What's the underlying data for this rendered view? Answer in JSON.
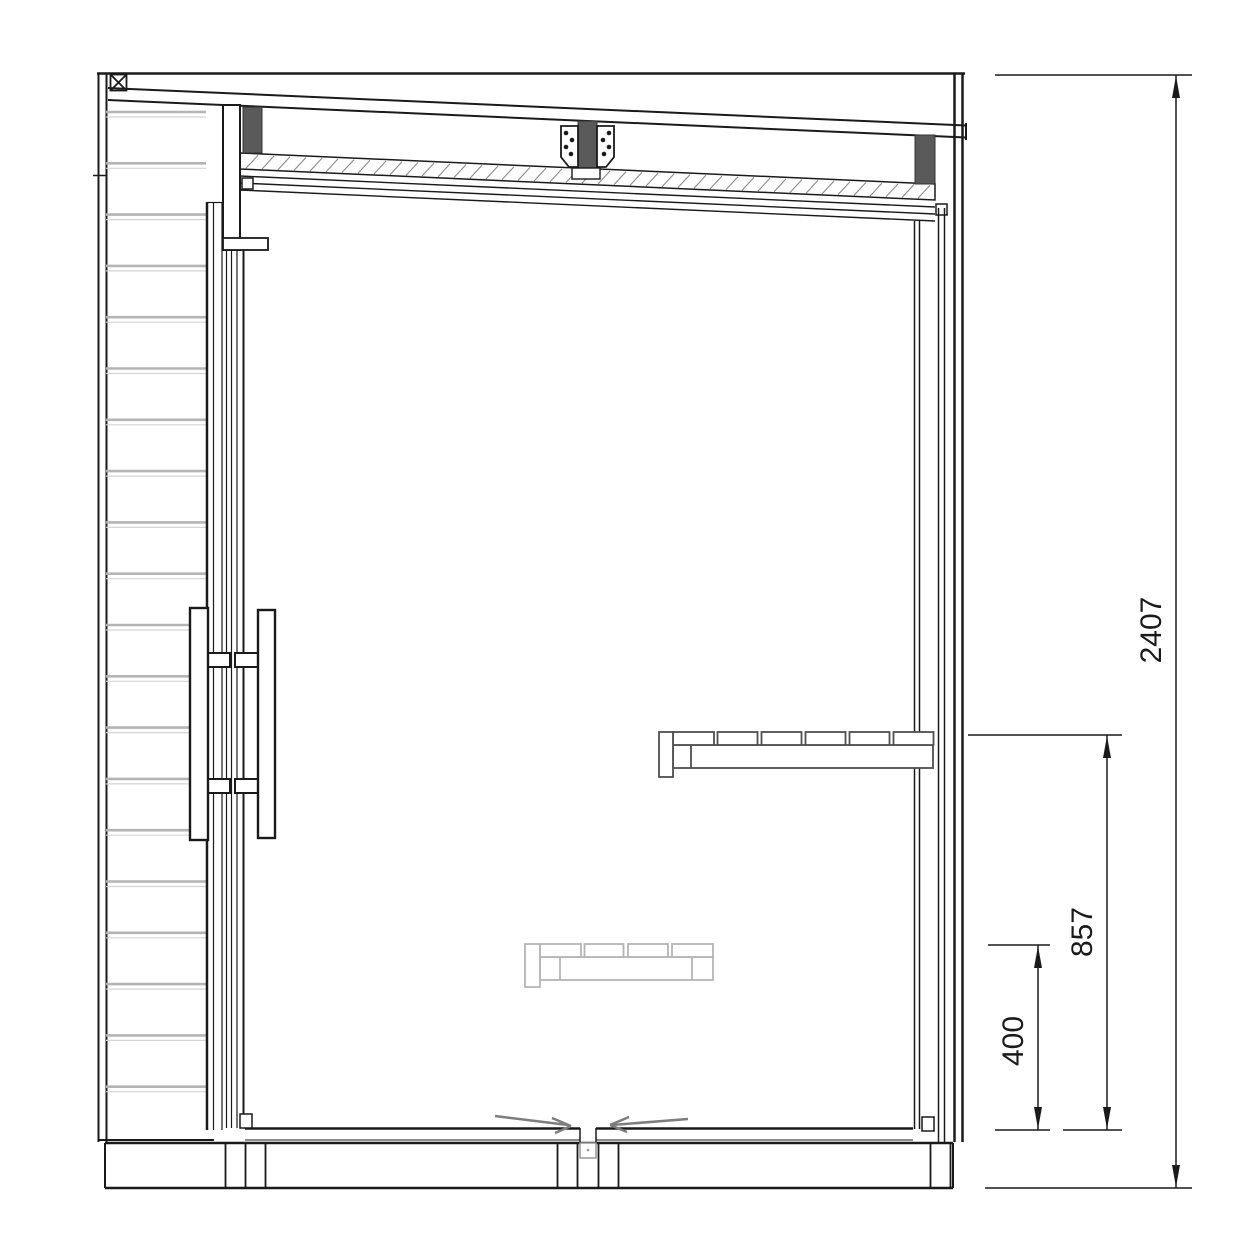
{
  "drawing": {
    "type": "technical-section-drawing",
    "dimension_labels": {
      "overall_height": "2407",
      "bench_height": "857",
      "lower_bench_height": "400"
    },
    "colors": {
      "main_line": "#1a1a1a",
      "rafter_fill": "#5a5a5a",
      "cladding_line": "#b4b4b4",
      "upper_bench_line": "#4f4f4f",
      "lower_bench_line": "#b5b5b5",
      "airflow_arrow": "#7d7d7d",
      "hatch_line": "#8a8a8a",
      "background": "#ffffff"
    },
    "icons": {
      "airflow_left": "arrow-right-icon",
      "airflow_right": "arrow-left-icon",
      "corner_marker": "crossed-box-icon"
    }
  }
}
